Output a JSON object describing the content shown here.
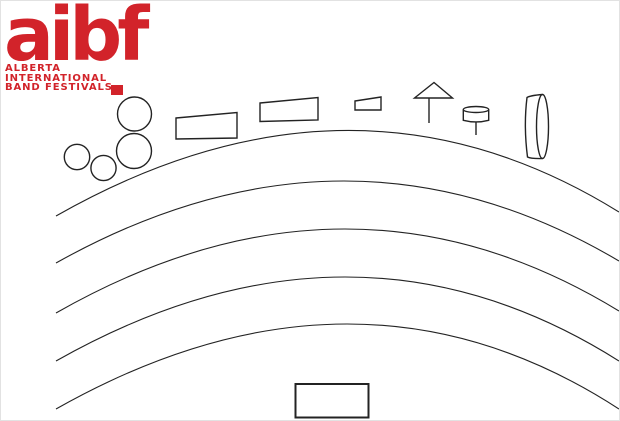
{
  "canvas": {
    "width": 620,
    "height": 421,
    "background": "#ffffff",
    "border_color": "#e2e2e2"
  },
  "logo": {
    "wordmark": "aibf",
    "tagline_lines": [
      "ALBERTA",
      "INTERNATIONAL",
      "BAND FESTIVALS"
    ],
    "color": "#d2232a"
  },
  "diagram": {
    "ink_color": "#232323",
    "icons": {
      "timpani": "circle-outline",
      "keyboard_percussion": "slanted-rectangle-outline",
      "percussion_table": "small-slanted-rectangle-outline",
      "cymbal_stand": "triangle-on-stem",
      "drum_on_stand": "small-cylinder-on-stem",
      "gong": "cylinder-3d-outline",
      "stage_rows": "five-concentric-arcs",
      "podium": "rectangle-outline"
    }
  }
}
